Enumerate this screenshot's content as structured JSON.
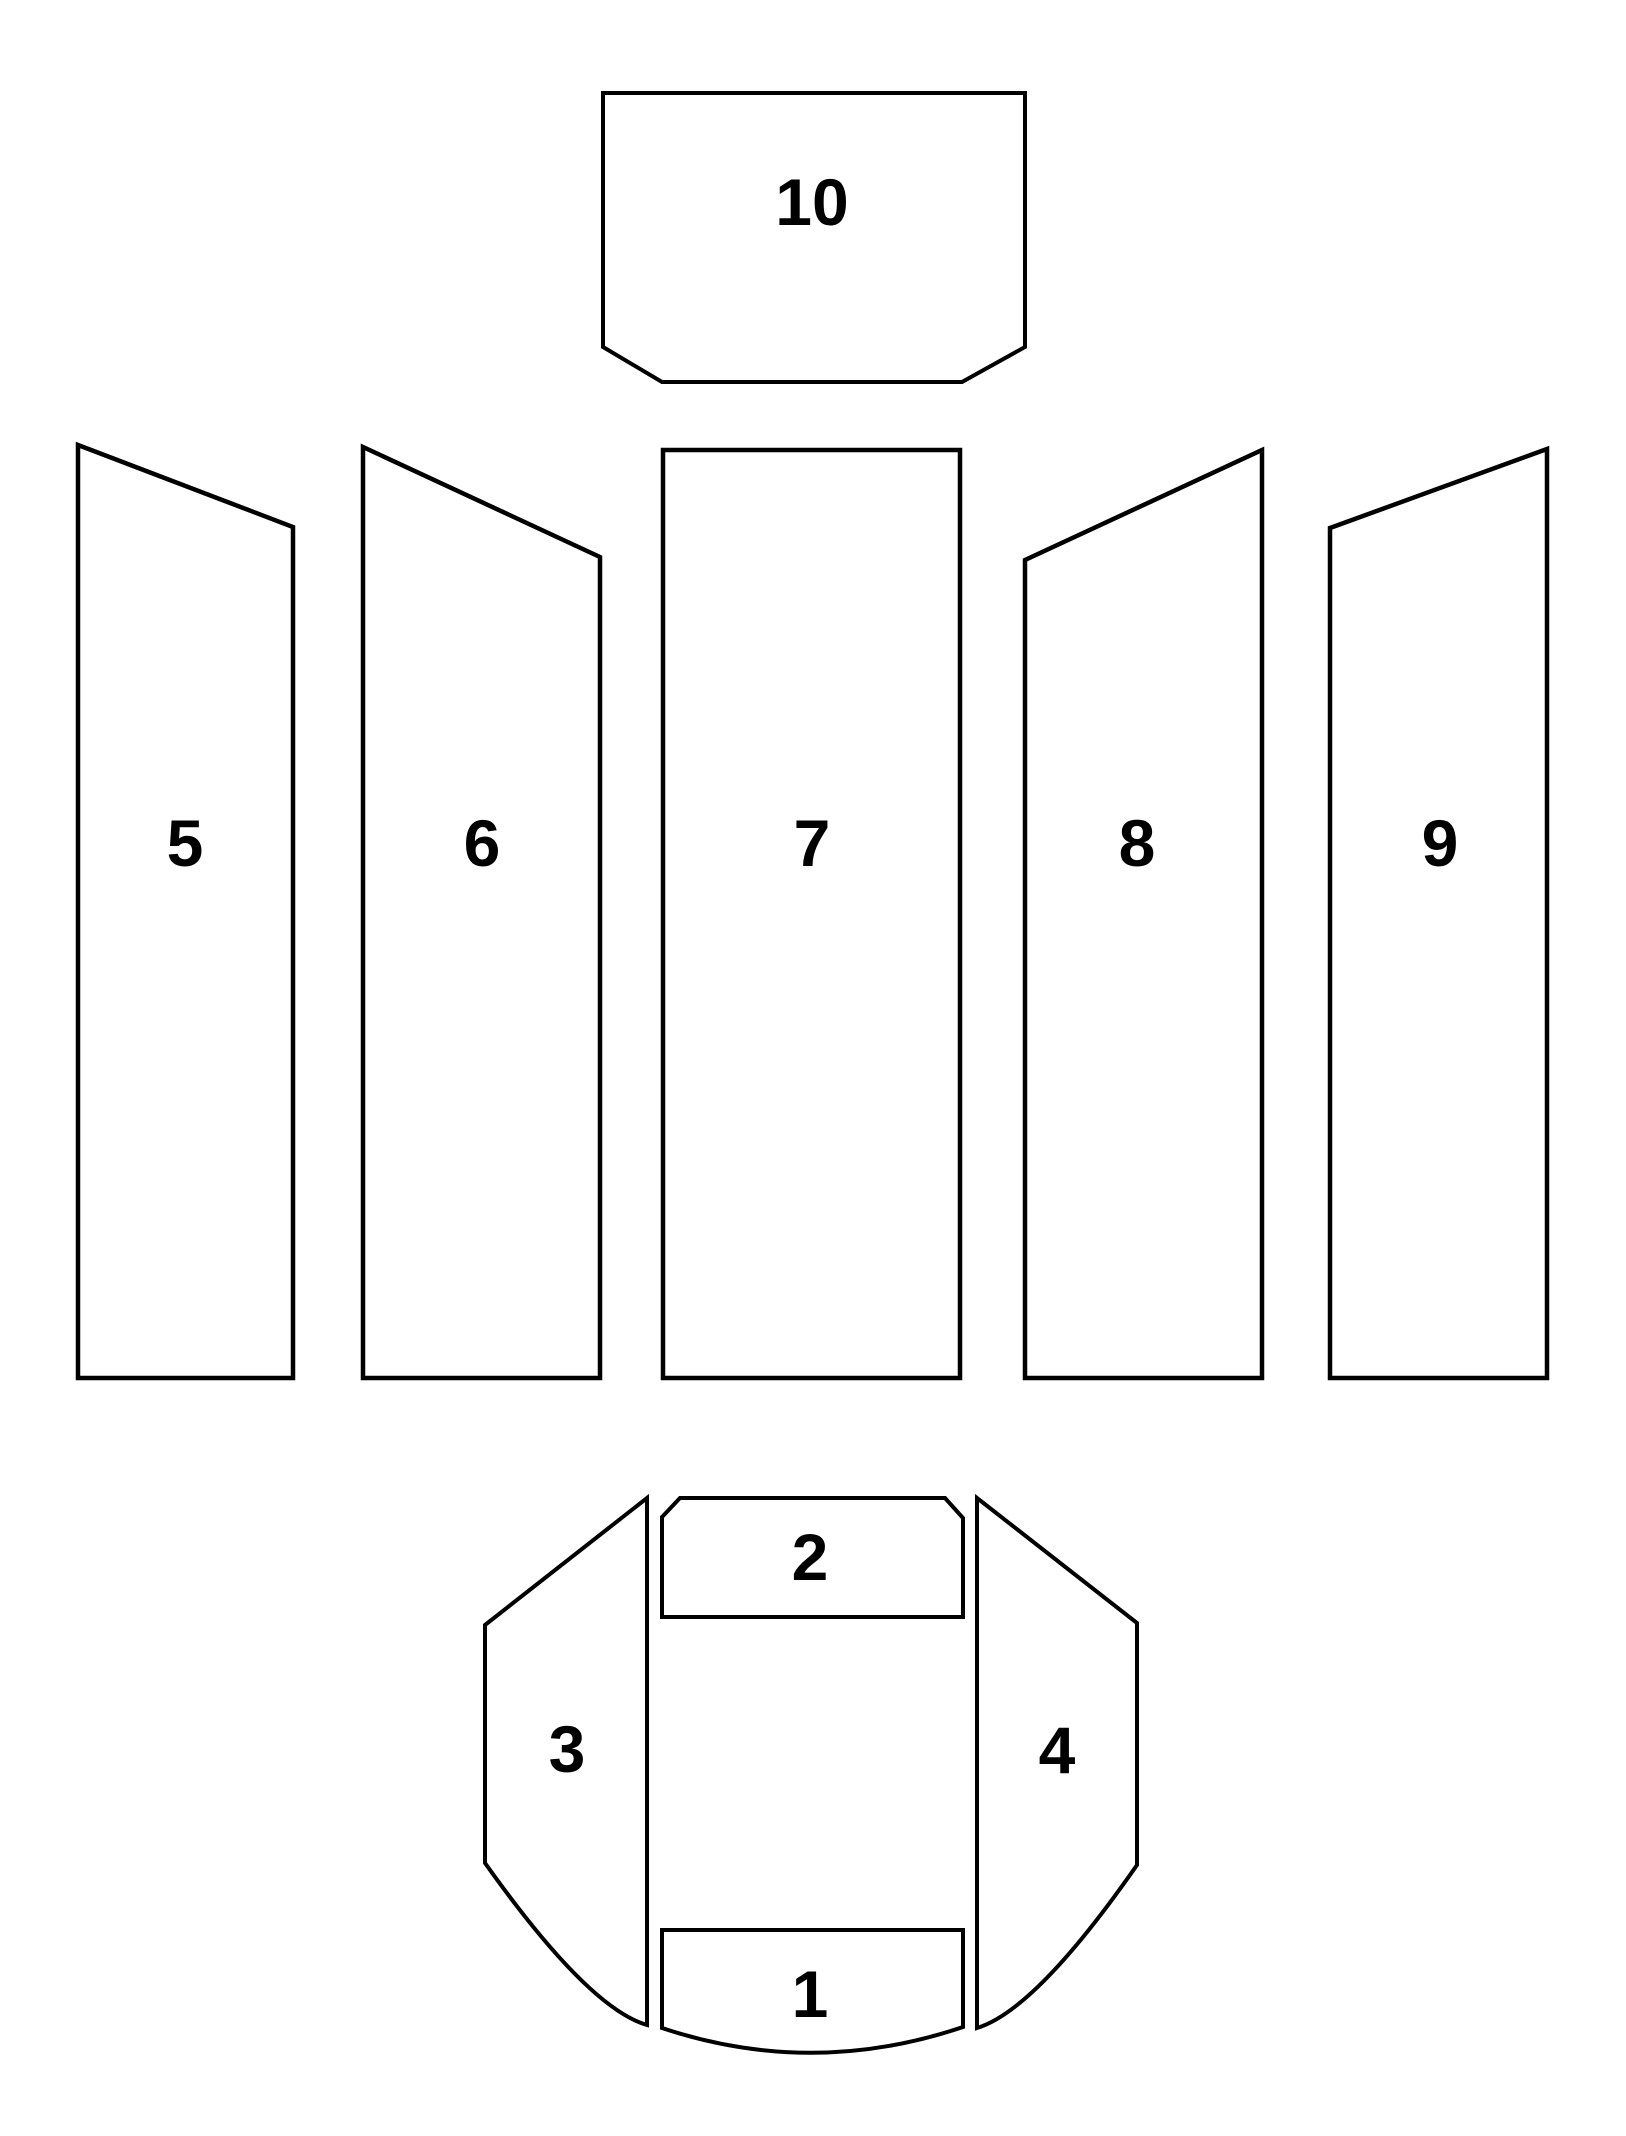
{
  "diagram": {
    "title": "firebrick-position-diagram",
    "background_color": "#ffffff",
    "outline_color": "#000000",
    "highlight_color": "#fe0000",
    "highlighted_part": "5",
    "parts": [
      {
        "label": "1",
        "highlighted": false
      },
      {
        "label": "2",
        "highlighted": false
      },
      {
        "label": "3",
        "highlighted": false
      },
      {
        "label": "4",
        "highlighted": false
      },
      {
        "label": "5",
        "highlighted": true
      },
      {
        "label": "6",
        "highlighted": false
      },
      {
        "label": "7",
        "highlighted": false
      },
      {
        "label": "8",
        "highlighted": false
      },
      {
        "label": "9",
        "highlighted": false
      },
      {
        "label": "10",
        "highlighted": false
      }
    ]
  }
}
